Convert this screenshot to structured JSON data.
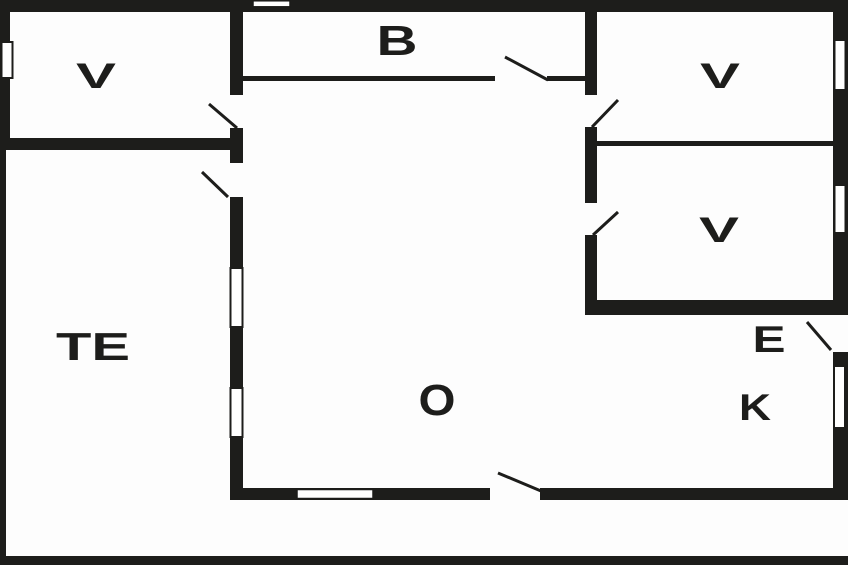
{
  "title": "Floor plan",
  "colors": {
    "wall": "#1d1d1b",
    "background": "#fdfdfd",
    "label_text": "#1d1d1b"
  },
  "rooms": [
    {
      "id": "bedroom-top-left",
      "label": "V"
    },
    {
      "id": "bathroom-top",
      "label": "B"
    },
    {
      "id": "bedroom-top-right",
      "label": "V"
    },
    {
      "id": "bedroom-mid-right",
      "label": "V"
    },
    {
      "id": "terrace",
      "label": "TE"
    },
    {
      "id": "living-room",
      "label": "O"
    },
    {
      "id": "entrance",
      "label": "E"
    },
    {
      "id": "kitchen",
      "label": "K"
    }
  ]
}
